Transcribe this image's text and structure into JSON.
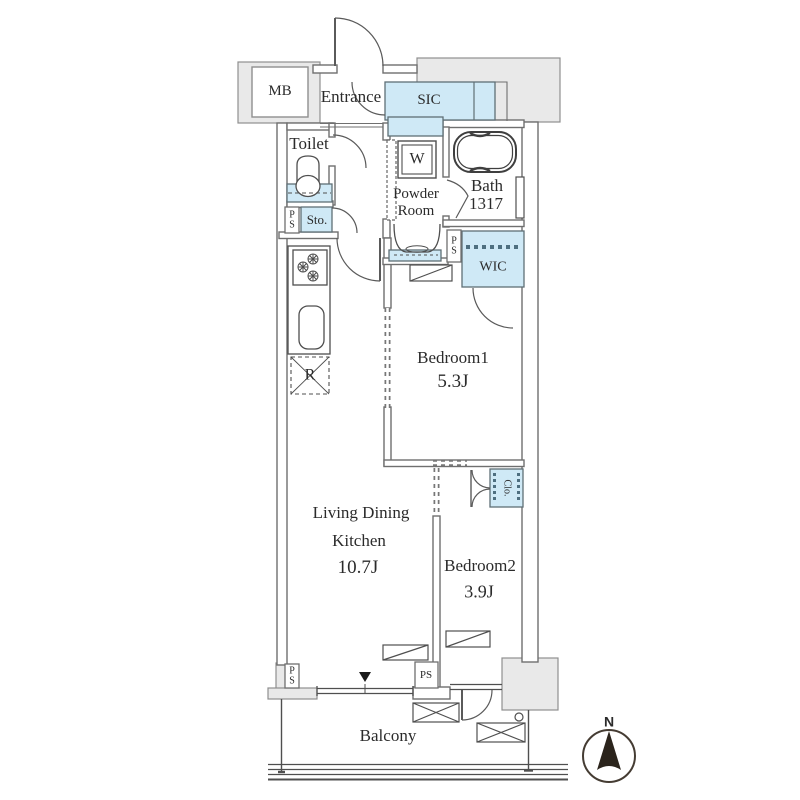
{
  "plan": {
    "title_hidden": "",
    "rooms": {
      "mb": "MB",
      "entrance": "Entrance",
      "sic": "SIC",
      "toilet": "Toilet",
      "washer": "W",
      "powder_line1": "Powder",
      "powder_line2": "Room",
      "bath": "Bath",
      "bath_size": "1317",
      "sto": "Sto.",
      "ps": "PS",
      "wic": "WIC",
      "bedroom1": "Bedroom1",
      "bedroom1_area": "5.3J",
      "fridge": "R",
      "ldk_line1": "Living Dining",
      "ldk_line2": "Kitchen",
      "ldk_area": "10.7J",
      "bedroom2": "Bedroom2",
      "bedroom2_area": "3.9J",
      "closet": "Clo.",
      "balcony": "Balcony"
    },
    "compass": {
      "north": "N"
    },
    "colors": {
      "room_accent_fill": "#cfe9f6",
      "common_area_fill": "#e9e9e9",
      "wall_line": "#6f6f6f",
      "fixture_line": "#4f4f4f",
      "hanger_dash": "#4e6f80",
      "text": "#2b2b2b",
      "needle": "#2b241c"
    }
  }
}
